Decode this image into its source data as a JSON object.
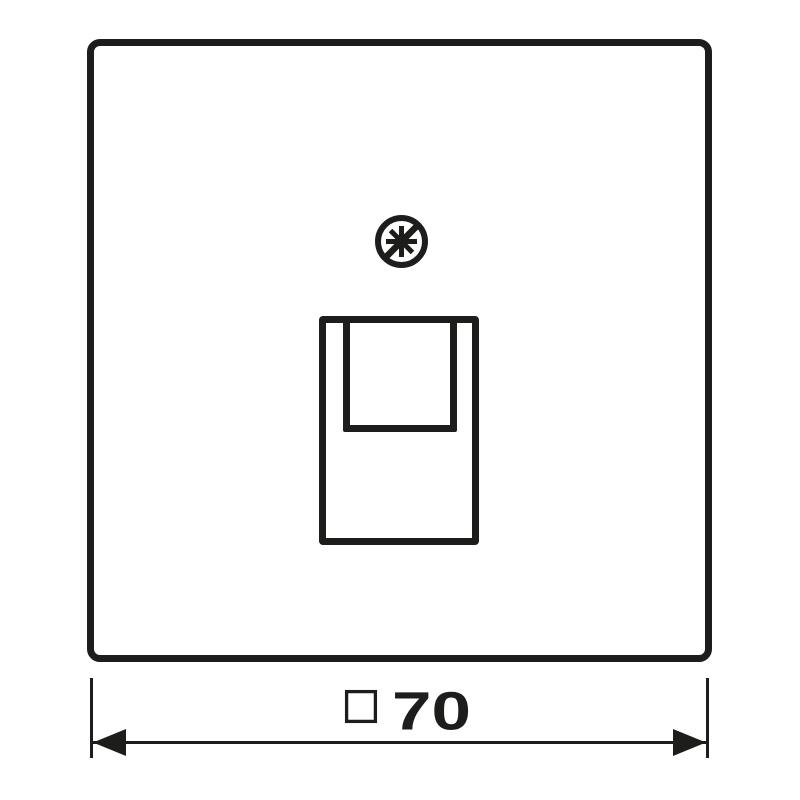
{
  "colors": {
    "line": "#1d1d1b",
    "background": "#ffffff"
  },
  "drawing": {
    "subject": "square cover plate with single modular-jack opening, front view",
    "icons": {
      "screw": "slashed-screw-head-icon",
      "socket": "rj45-jack-opening-outline",
      "dimension_symbol": "square-symbol"
    }
  },
  "dimension": {
    "symbol": "□",
    "value": "70",
    "label": "□70"
  }
}
